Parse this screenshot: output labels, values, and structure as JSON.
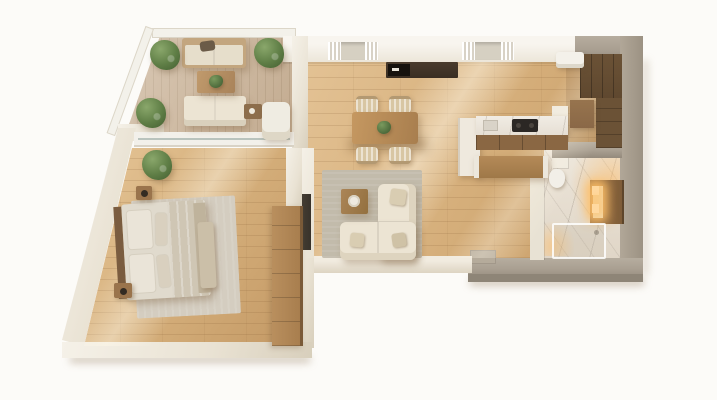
{
  "scene": {
    "type": "3d-apartment-floor-plan-top-view",
    "background": "plain-white",
    "visible_text": "none",
    "rooms": [
      {
        "name": "terrace",
        "floor": "wood-deck-vertical-planks",
        "items": [
          "outdoor-sofa-upper",
          "outdoor-sofa-lower",
          "coffee-table-with-plant",
          "side-table",
          "lounge-chair",
          "potted-plant-corner",
          "potted-plant-right",
          "potted-plant-lower",
          "glass-railing-top",
          "glass-railing-diagonal"
        ]
      },
      {
        "name": "living-dining",
        "floor": "oak-planks",
        "items": [
          "dining-table",
          "dining-chairs-4",
          "plant-centerpiece",
          "media-console",
          "fireplace-unit",
          "window-with-curtains-left",
          "window-with-curtains-right",
          "corner-sofa",
          "throw-cushions-3",
          "coffee-table-with-tray",
          "area-rug",
          "wall-tv"
        ]
      },
      {
        "name": "kitchen",
        "floor": "oak-planks",
        "items": [
          "tall-cabinet",
          "marble-countertop",
          "sink",
          "cooktop",
          "cabinet-fronts",
          "kitchen-island"
        ]
      },
      {
        "name": "hallway-closet",
        "floor": "oak-planks",
        "items": [
          "ac-unit",
          "wardrobe-top",
          "wardrobe-side",
          "dresser"
        ]
      },
      {
        "name": "bathroom",
        "floor": "white-marble",
        "items": [
          "toilet",
          "wood-vanity-with-accent-lighting",
          "glass-shower-enclosure",
          "warm-accent-glow"
        ]
      },
      {
        "name": "bedroom",
        "floor": "oak-planks",
        "items": [
          "double-bed",
          "headboard",
          "pillows-4",
          "blanket",
          "foot-runner",
          "bench",
          "area-rug",
          "nightstand-with-lamp-upper",
          "nightstand-with-lamp-lower",
          "wardrobe-strip",
          "potted-plant",
          "sliding-glass-door-to-terrace"
        ]
      }
    ]
  },
  "palette": {
    "bg": "#fcfbf8",
    "wall_cream": "#e9e2d3",
    "wall_cream_light": "#f5f1e8",
    "wall_cream_dark": "#d8cfbc",
    "wall_gray": "#aaa092",
    "wall_gray_dark": "#948a7c",
    "railing": "#f3f1ea",
    "floor_light": "#e3c294",
    "floor_dark": "#c89e69",
    "plank_line": "rgba(125,85,45,0.16)",
    "deck": "#cbb499",
    "deck_line": "#bda68a",
    "marble": "#ece5da",
    "marble_dark": "#e0d6c7",
    "vein": "rgba(150,140,128,0.3)",
    "wood_dark": "#5f482f",
    "wood_mid": "#a87e4e",
    "wood_cab": "#8a6743",
    "console_dark": "#3a2e23",
    "island_top": "#b58a58",
    "sofa": "#ece4d3",
    "sofa_shade": "#ded4bf",
    "cushion": "#d9cdb2",
    "chair_wood": "#d8c6a3",
    "rug": "#c2bbab",
    "rug_bed": "#d4cdc0",
    "linen": "#e0dacd",
    "pillow": "#eae4d8",
    "blanket": "#cfc6b4",
    "headboard": "#7b5d40",
    "nightstand": "#9a744c",
    "plant_hi": "#8aa76b",
    "plant_mid": "#5f7e46",
    "plant_dark": "#445f31",
    "glow": "#ffd9a0",
    "tv": "#38322a",
    "cooktop": "#2b2724"
  }
}
